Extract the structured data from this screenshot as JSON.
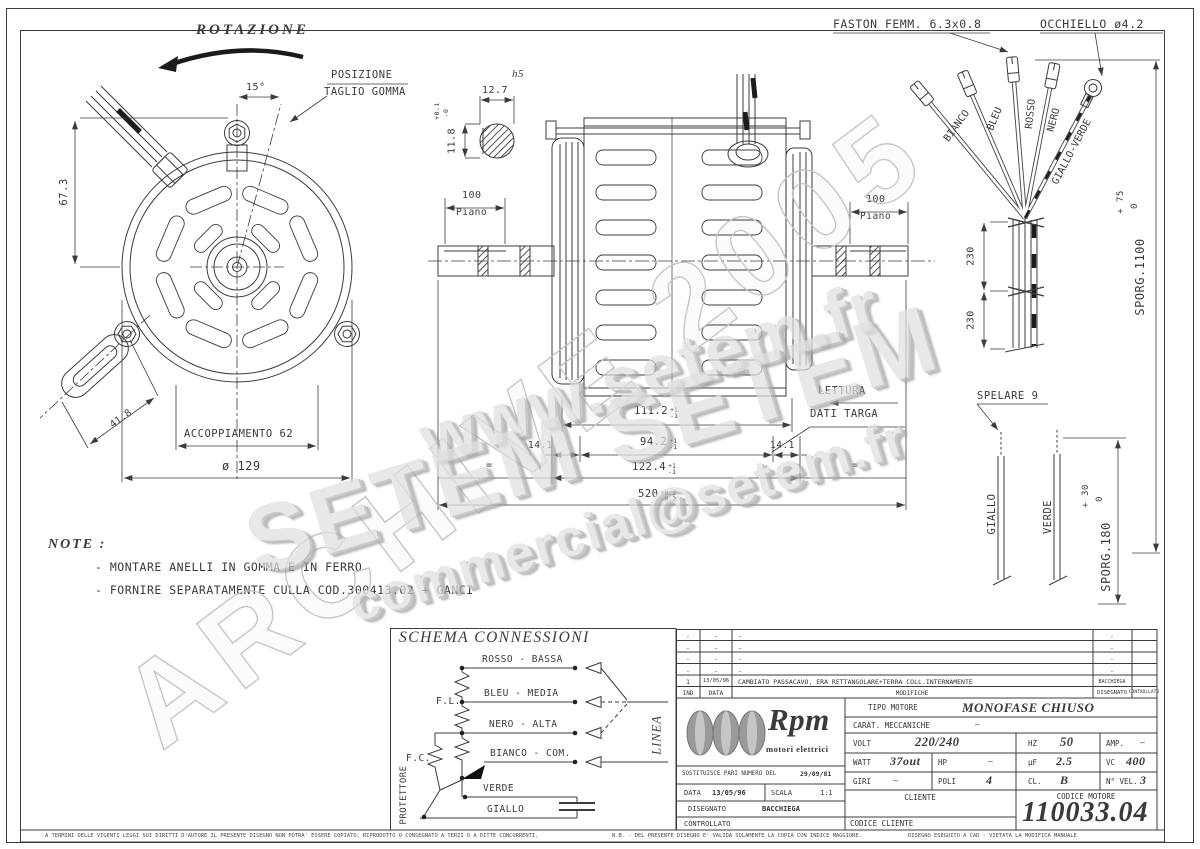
{
  "watermarks": {
    "www": "www.setem.fr",
    "setem": "SETEM  SETEM",
    "email": "commercial@setem.fr",
    "archive": "ARCHIVE 2005"
  },
  "front_view": {
    "rotazione": "ROTAZIONE",
    "angle": "15°",
    "posizione1": "POSIZIONE",
    "posizione2": "TAGLIO GOMMA",
    "dim_height": "67.3",
    "dim_stud": "41.8",
    "coupling": "ACCOPPIAMENTO 62",
    "diameter": "ø 129"
  },
  "shaft_detail": {
    "fit": "h5",
    "width": "12.7",
    "height": "11.8",
    "tol_plus": "+0.1",
    "tol_minus": "-0"
  },
  "side_view": {
    "piano_dim": "100",
    "piano": "Piano",
    "piano_dim_r": "100",
    "piano_r": "Piano",
    "len_pack_outer": "111.2",
    "len_pack": "94.2",
    "len_shoulder_l": "14.1",
    "len_shoulder_r": "14.1",
    "len_stator": "122.4",
    "len_total": "520",
    "tol1p": "+1",
    "tol1m": "-1",
    "tol2p": "+1",
    "tol2m": "-1",
    "tol3p": "+1",
    "tol3m": "-1",
    "tol4p": "+0.2",
    "tol4m": "-0.2",
    "equal": "=",
    "equal2": "=",
    "lettura1": "LETTURA",
    "lettura2": "DATI TARGA"
  },
  "cables": {
    "faston": "FASTON FEMM. 6.3x0.8",
    "occhiello": "OCCHIELLO ø4.2",
    "wires": [
      "BIANCO",
      "BLEU",
      "ROSSO",
      "NERO",
      "GIALLO-VERDE"
    ],
    "tie_dim1": "230",
    "tie_dim2": "230",
    "sporg1": "SPORG.1100",
    "sporg1_tp": "+ 75",
    "sporg1_tm": "0",
    "spelare": "SPELARE 9",
    "wire_yellow": "GIALLO",
    "wire_green": "VERDE",
    "sporg2": "SPORG.180",
    "sporg2_tp": "+ 30",
    "sporg2_tm": "0"
  },
  "note": {
    "title": "NOTE :",
    "line1": "- MONTARE ANELLI IN GOMMA E IN FERRO",
    "line2": "- FORNIRE SEPARATAMENTE CULLA COD.300413.02 + GANCI"
  },
  "schema": {
    "title": "SCHEMA CONNESSIONI",
    "l1": "ROSSO - BASSA",
    "l2": "BLEU - MEDIA",
    "l3": "NERO - ALTA",
    "l4": "BIANCO - COM.",
    "l5": "VERDE",
    "l6": "GIALLO",
    "fl": "F.L.",
    "fc": "F.C.",
    "protettore": "PROTETTORE",
    "linea": "LINEA"
  },
  "revision_table": {
    "headers": {
      "ind": "IND",
      "data": "DATA",
      "modifiche": "MODIFICHE",
      "disegnato": "DISEGNATO",
      "controllato": "CONTROLLATO"
    },
    "rows": [
      {
        "ind": "-",
        "data": "-",
        "text": "-",
        "drawn": "-",
        "checked": ""
      },
      {
        "ind": "-",
        "data": "-",
        "text": "-",
        "drawn": "-",
        "checked": ""
      },
      {
        "ind": "-",
        "data": "-",
        "text": "-",
        "drawn": "-",
        "checked": ""
      },
      {
        "ind": "-",
        "data": "-",
        "text": "-",
        "drawn": "-",
        "checked": ""
      },
      {
        "ind": "1",
        "data": "13/05/96",
        "text": "CAMBIATO PASSACAVO, ERA RETTANGOLARE+TERRA COLL.INTERNAMENTE",
        "drawn": "BACCHIEGA",
        "checked": ""
      }
    ]
  },
  "title_block": {
    "brand": "Rpm",
    "brand_sub": "motori elettrici",
    "sostituisce": "SOSTITUISCE PARI NUMERO DEL",
    "sostituisce_val": "29/09/81",
    "data_l": "DATA",
    "data_v": "13/05/96",
    "scala_l": "SCALA",
    "scala_v": "1:1",
    "disegnato_l": "DISEGNATO",
    "disegnato_v": "BACCHIEGA",
    "controllato_l": "CONTROLLATO",
    "tipo_l": "TIPO MOTORE",
    "tipo_v": "MONOFASE CHIUSO",
    "carat_l": "CARAT. MECCANICHE",
    "carat_v": "—",
    "volt_l": "VOLT",
    "volt_v": "220/240",
    "hz_l": "HZ",
    "hz_v": "50",
    "amp_l": "AMP.",
    "amp_v": "—",
    "watt_l": "WATT",
    "watt_v": "37out",
    "hp_l": "HP",
    "hp_v": "—",
    "uf_l": "µF",
    "uf_v": "2.5",
    "vc_l": "VC",
    "vc_v": "400",
    "giri_l": "GIRI",
    "giri_v": "—",
    "poli_l": "POLI",
    "poli_v": "4",
    "cl_l": "CL.",
    "cl_v": "B",
    "nvel_l": "N° VEL.",
    "nvel_v": "3",
    "cliente_l": "CLIENTE",
    "cod_motore_l": "CODICE MOTORE",
    "cod_motore_v": "110033.04",
    "cod_cliente_l": "CODICE CLIENTE"
  },
  "footer": {
    "left": "A TERMINI DELLE VIGENTI LEGGI SUI DIRITTI D'AUTORE IL PRESENTE DISEGNO NON POTRA' ESSERE COPIATO, RIPRODOTTO O CONSEGNATO A TERZI O A DITTE CONCORRENTI.",
    "nb": "N.B. - DEL PRESENTE DISEGNO E' VALIDA SOLAMENTE LA COPIA CON INDICE MAGGIORE.",
    "cad": "DISEGNO ESEGUITO A CAD - VIETATA LA MODIFICA MANUALE"
  },
  "colors": {
    "line": "#3c3c3c",
    "watermark": "#d8d8d8",
    "paper": "#ffffff"
  }
}
